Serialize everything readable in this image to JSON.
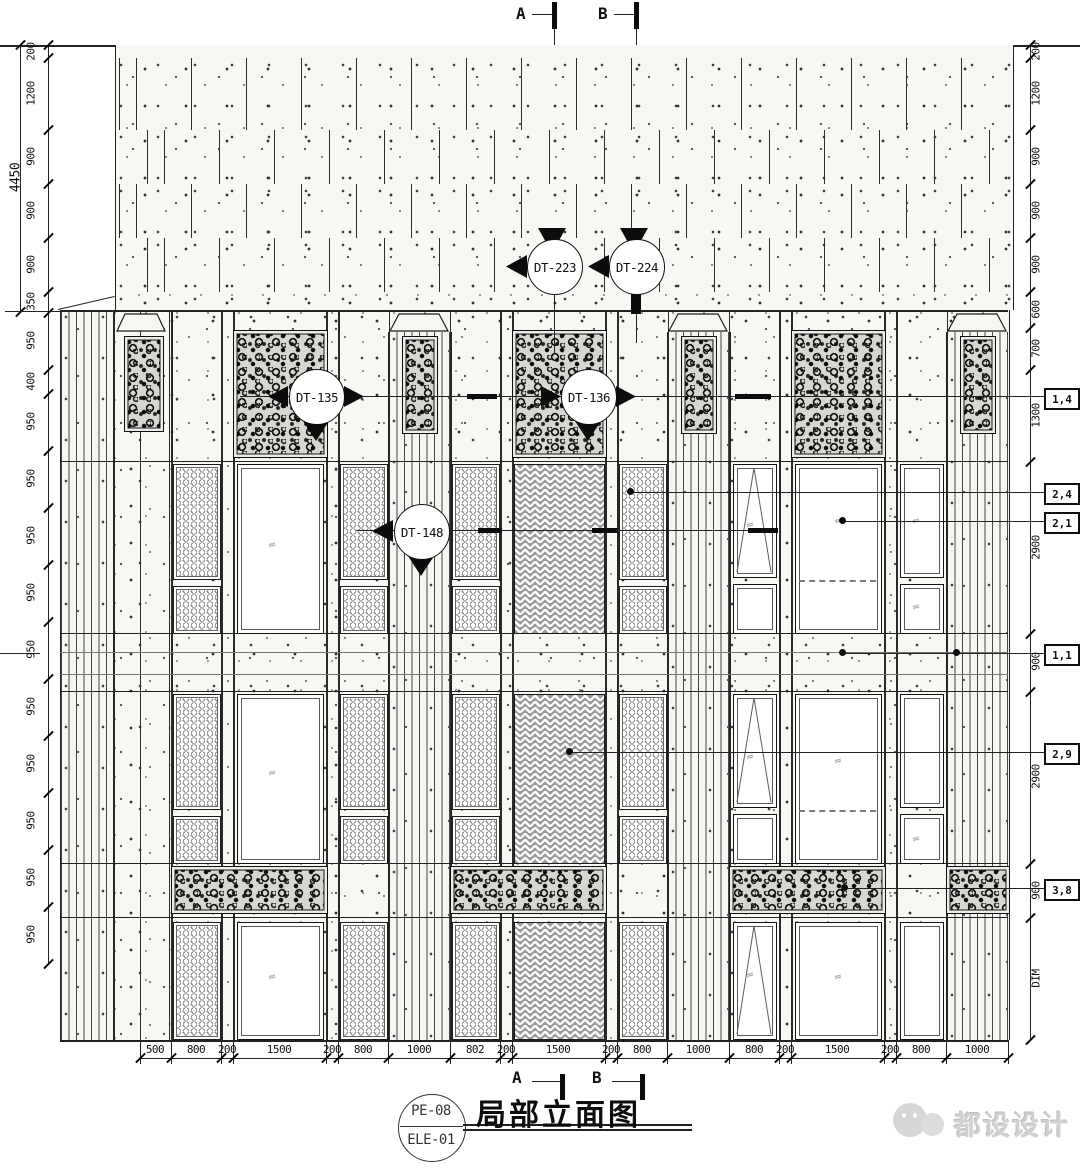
{
  "markers": {
    "top_a": "A",
    "top_b": "B",
    "bottom_a": "A",
    "bottom_b": "B"
  },
  "callouts": {
    "dt223": "DT-223",
    "dt224": "DT-224",
    "dt135": "DT-135",
    "dt136": "DT-136",
    "dt148": "DT-148"
  },
  "dimensions": {
    "left_overall": "4450",
    "left": [
      "200",
      "1200",
      "900",
      "900",
      "900",
      "350",
      "950",
      "400",
      "950",
      "950",
      "950",
      "950",
      "950",
      "950",
      "950",
      "950",
      "950",
      "950"
    ],
    "right": [
      "200",
      "1200",
      "900",
      "900",
      "900",
      "600",
      "700",
      "1300",
      "2900",
      "900",
      "2900",
      "900",
      "DIM"
    ],
    "bottom": [
      "500",
      "800",
      "200",
      "1500",
      "200",
      "800",
      "1000",
      "802",
      "200",
      "1500",
      "200",
      "800",
      "1000",
      "800",
      "200",
      "1500",
      "200",
      "800",
      "1000"
    ]
  },
  "tags": [
    "1,4",
    "2,4",
    "2,1",
    "1,1",
    "2,9",
    "3,8"
  ],
  "title_block": {
    "sheet_no": "PE-08",
    "drawing_no": "ELE-01",
    "title": "局部立面图"
  },
  "watermark": {
    "text": "都设设计"
  },
  "icons": {
    "glass_symbol": "≈"
  },
  "colors": {
    "line": "#1a1a1a",
    "paper": "#ffffff",
    "speckle": "#555555",
    "watermark_gray": "#d0d0d0"
  }
}
